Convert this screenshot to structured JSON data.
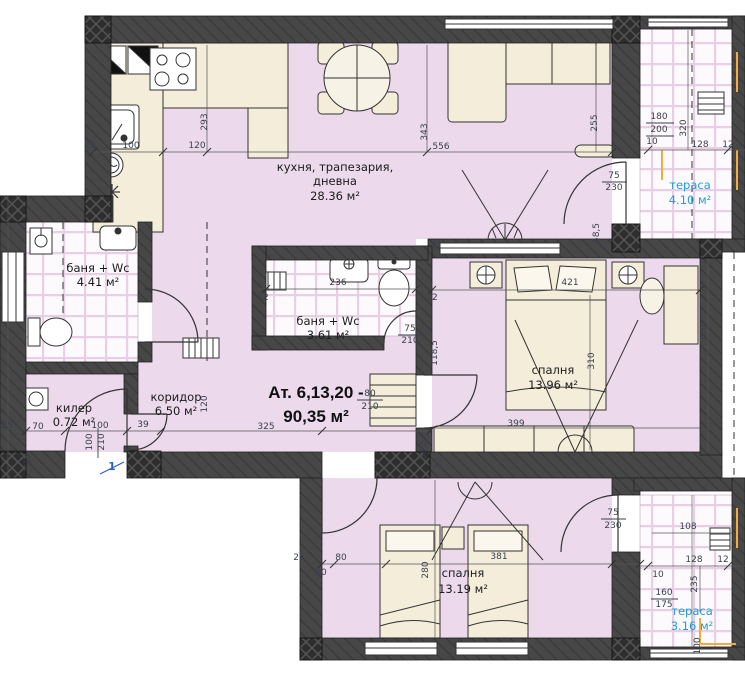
{
  "title": {
    "line1": "Ат. 6,13,20 -",
    "line2": "90,35 м²"
  },
  "rooms": [
    {
      "id": "kitchen-dining-living",
      "line1": "кухня, трапезария,",
      "line2": "дневна",
      "area": "28.36 м²"
    },
    {
      "id": "bath-left",
      "line1": "баня + Wc",
      "area": "4.41 м²"
    },
    {
      "id": "bath-middle",
      "line1": "баня + Wc",
      "area": "3.61 м²"
    },
    {
      "id": "closet",
      "line1": "килер",
      "area": "0.72 м²"
    },
    {
      "id": "corridor",
      "line1": "коридор",
      "area": "6.50 м²"
    },
    {
      "id": "bedroom-right",
      "line1": "спалня",
      "area": "13.96 м²"
    },
    {
      "id": "bedroom-bottom",
      "line1": "спалня",
      "area": "13.19 м²"
    },
    {
      "id": "terrace-top",
      "line1": "тераса",
      "area": "4.10 м²"
    },
    {
      "id": "terrace-bottom",
      "line1": "тераса",
      "area": "3.16 м²"
    }
  ],
  "entrance_marker": "1",
  "colors": {
    "wall": "#474747",
    "room_fill": "#ecd9ec",
    "furniture_fill": "#f4edda",
    "tile_line": "#e8cfe6",
    "dimension_text": "#39404e",
    "terrace_text": "#1f9ed6",
    "entrance_marker": "#2e62c8",
    "accent_orange": "#f5a93f"
  },
  "dimensions": [
    {
      "t": "293",
      "x": 207,
      "y": 122,
      "r": -90
    },
    {
      "t": "25",
      "x": 90,
      "y": 148,
      "r": 0
    },
    {
      "t": "100",
      "x": 131,
      "y": 148,
      "r": 0
    },
    {
      "t": "120",
      "x": 197,
      "y": 148,
      "r": 0
    },
    {
      "t": "343",
      "x": 427,
      "y": 132,
      "r": -90
    },
    {
      "t": "556",
      "x": 441,
      "y": 149,
      "r": 0
    },
    {
      "t": "255",
      "x": 597,
      "y": 123,
      "r": -90
    },
    {
      "t": "75",
      "x": 614,
      "y": 178,
      "r": 0
    },
    {
      "t": "230",
      "x": 614,
      "y": 190,
      "r": 0
    },
    {
      "t": "180",
      "x": 659,
      "y": 119,
      "r": 0
    },
    {
      "t": "200",
      "x": 659,
      "y": 132,
      "r": 0
    },
    {
      "t": "10",
      "x": 652,
      "y": 144,
      "r": 0
    },
    {
      "t": "320",
      "x": 686,
      "y": 128,
      "r": -90
    },
    {
      "t": "128",
      "x": 700,
      "y": 147,
      "r": 0
    },
    {
      "t": "12",
      "x": 728,
      "y": 147,
      "r": 0
    },
    {
      "t": "12",
      "x": 440,
      "y": 244,
      "r": -90
    },
    {
      "t": "58,5",
      "x": 599,
      "y": 233,
      "r": -90
    },
    {
      "t": "421",
      "x": 570,
      "y": 285,
      "r": 0
    },
    {
      "t": "310",
      "x": 594,
      "y": 361,
      "r": -90
    },
    {
      "t": "160",
      "x": 706,
      "y": 333,
      "r": -90
    },
    {
      "t": "236",
      "x": 338,
      "y": 285,
      "r": 0
    },
    {
      "t": "12",
      "x": 263,
      "y": 300,
      "r": 0
    },
    {
      "t": "12",
      "x": 432,
      "y": 300,
      "r": 0
    },
    {
      "t": "75",
      "x": 410,
      "y": 331,
      "r": 0
    },
    {
      "t": "210",
      "x": 410,
      "y": 343,
      "r": 0
    },
    {
      "t": "118,5",
      "x": 437,
      "y": 353,
      "r": -90
    },
    {
      "t": "120",
      "x": 207,
      "y": 404,
      "r": -90
    },
    {
      "t": "80",
      "x": 370,
      "y": 396,
      "r": 0
    },
    {
      "t": "210",
      "x": 370,
      "y": 409,
      "r": 0
    },
    {
      "t": "325",
      "x": 266,
      "y": 429,
      "r": 0
    },
    {
      "t": "25",
      "x": 7,
      "y": 428,
      "r": 0
    },
    {
      "t": "70",
      "x": 38,
      "y": 429,
      "r": 0
    },
    {
      "t": "100",
      "x": 100,
      "y": 428,
      "r": 0
    },
    {
      "t": "39",
      "x": 143,
      "y": 427,
      "r": 0
    },
    {
      "t": "100",
      "x": 92,
      "y": 442,
      "r": -90
    },
    {
      "t": "210",
      "x": 104,
      "y": 442,
      "r": -90
    },
    {
      "t": "25",
      "x": 30,
      "y": 460,
      "r": -90
    },
    {
      "t": "58,5",
      "x": 426,
      "y": 450,
      "r": -90
    },
    {
      "t": "12",
      "x": 441,
      "y": 463,
      "r": -90
    },
    {
      "t": "399",
      "x": 516,
      "y": 426,
      "r": 0
    },
    {
      "t": "25",
      "x": 299,
      "y": 560,
      "r": 0
    },
    {
      "t": "80",
      "x": 341,
      "y": 560,
      "r": 0
    },
    {
      "t": "10",
      "x": 321,
      "y": 575,
      "r": 0
    },
    {
      "t": "280",
      "x": 428,
      "y": 570,
      "r": -90
    },
    {
      "t": "381",
      "x": 499,
      "y": 559,
      "r": 0
    },
    {
      "t": "75",
      "x": 613,
      "y": 515,
      "r": 0
    },
    {
      "t": "230",
      "x": 613,
      "y": 528,
      "r": 0
    },
    {
      "t": "108",
      "x": 688,
      "y": 529,
      "r": 0
    },
    {
      "t": "128",
      "x": 694,
      "y": 562,
      "r": 0
    },
    {
      "t": "12",
      "x": 723,
      "y": 562,
      "r": 0
    },
    {
      "t": "10",
      "x": 658,
      "y": 577,
      "r": 0
    },
    {
      "t": "235",
      "x": 697,
      "y": 584,
      "r": -90
    },
    {
      "t": "160",
      "x": 664,
      "y": 595,
      "r": 0
    },
    {
      "t": "175",
      "x": 664,
      "y": 607,
      "r": 0
    },
    {
      "t": "100",
      "x": 700,
      "y": 646,
      "r": -90
    }
  ]
}
